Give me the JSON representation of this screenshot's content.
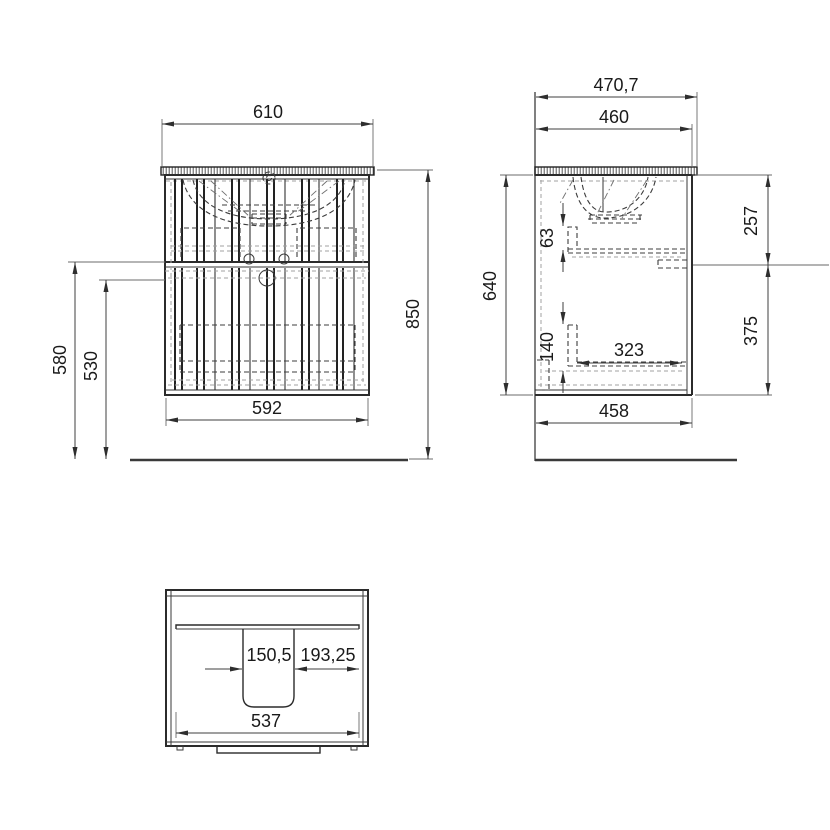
{
  "drawing": {
    "dims": {
      "front_width_top": "610",
      "front_width_body": "592",
      "front_height_total": "850",
      "front_floor_to_split": "580",
      "front_floor_to_drawer": "530",
      "side_depth_total": "470,7",
      "side_depth_counter": "460",
      "side_body_height": "640",
      "side_upper_section": "257",
      "side_lower_section": "375",
      "side_upper_drawer_back": "63",
      "side_lower_drawer_back": "140",
      "side_drawer_depth": "323",
      "side_body_depth": "458",
      "plan_cutout_width": "150,5",
      "plan_cutout_to_side": "193,25",
      "plan_inner_width": "537"
    }
  }
}
